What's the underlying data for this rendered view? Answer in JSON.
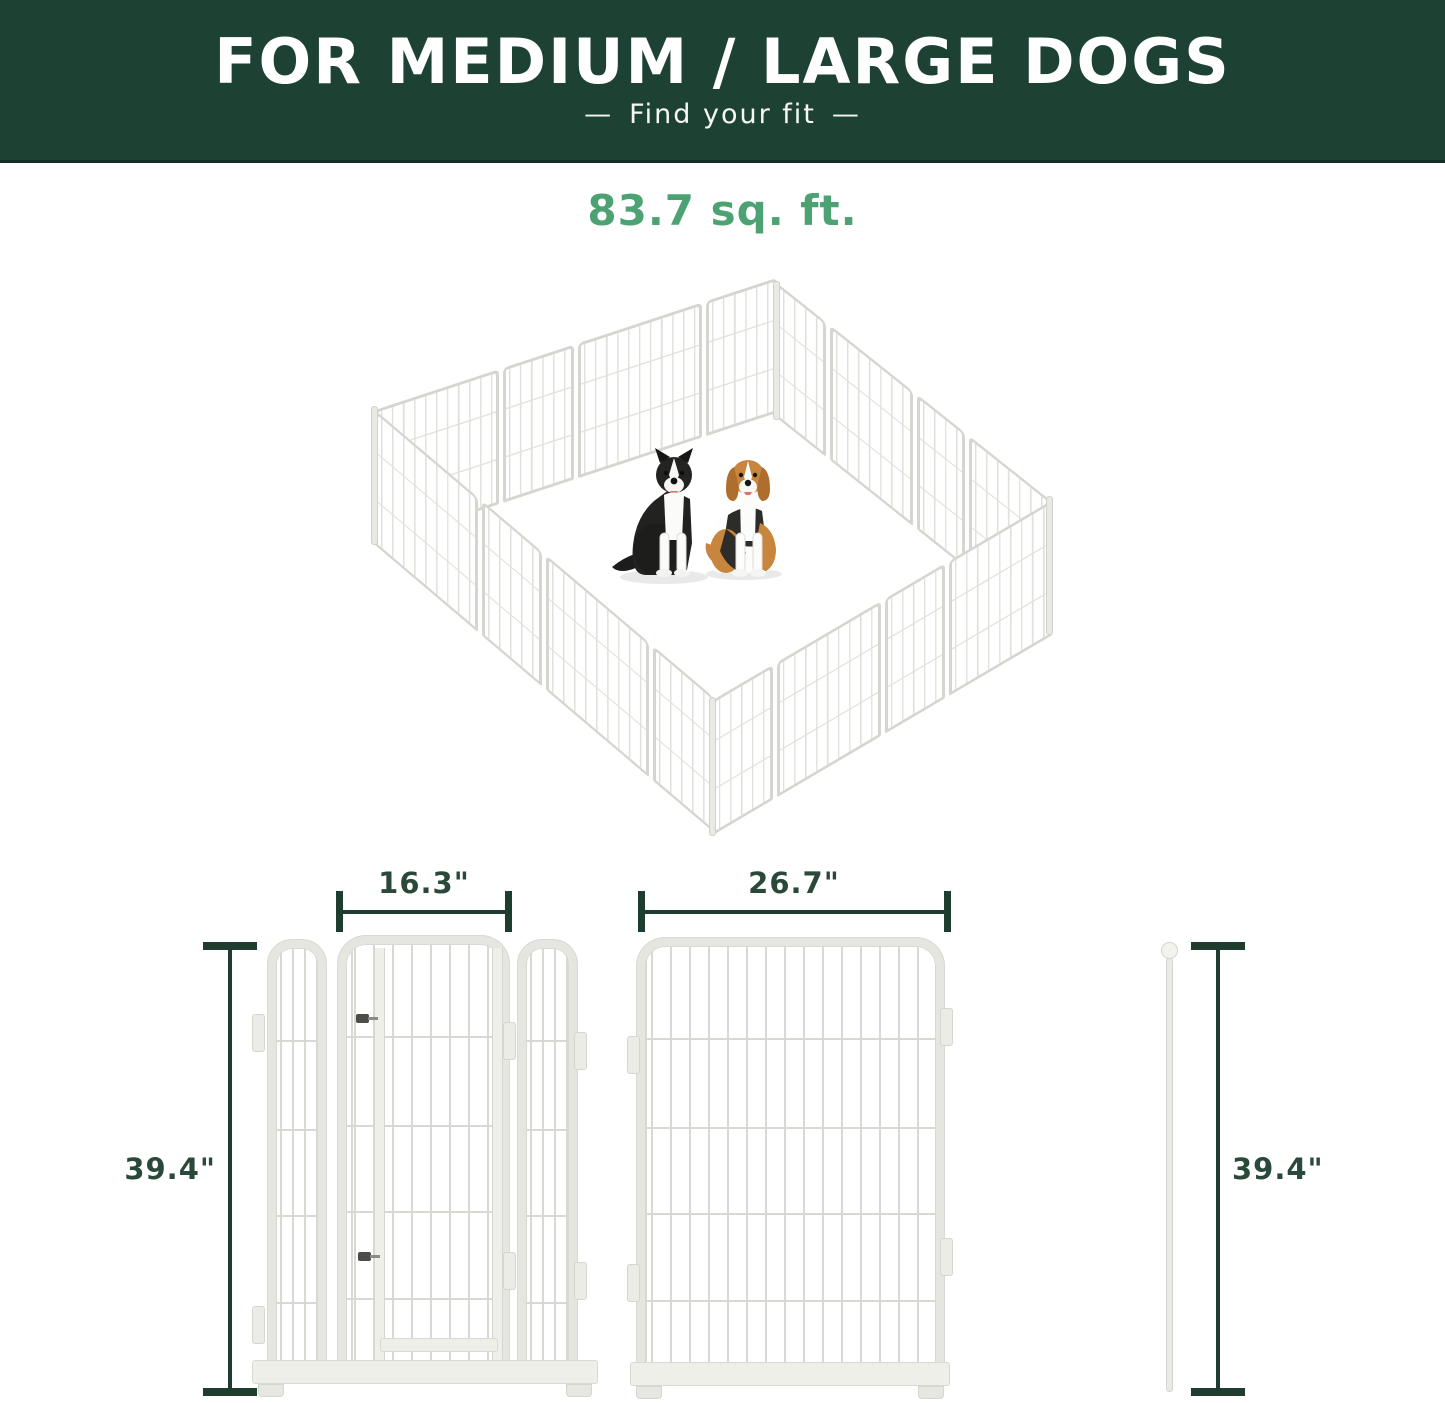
{
  "banner": {
    "title": "FOR MEDIUM / LARGE DOGS",
    "dash": "—",
    "subtitle": "Find your fit",
    "bg_color": "#1d4233",
    "text_color": "#ffffff"
  },
  "area": {
    "label": "83.7 sq. ft.",
    "color": "#4da273"
  },
  "illustration": {
    "name": "isometric-dog-playpen",
    "dogs": [
      "border-collie",
      "beagle"
    ],
    "panel_color": "#e3e3dd"
  },
  "dimensions": {
    "gate_panel": {
      "width_label": "16.3\"",
      "height_label": "39.4\""
    },
    "large_panel": {
      "width_label": "26.7\"",
      "height_label": "39.4\""
    },
    "line_color": "#1e3d2f",
    "text_color": "#2a4939"
  }
}
